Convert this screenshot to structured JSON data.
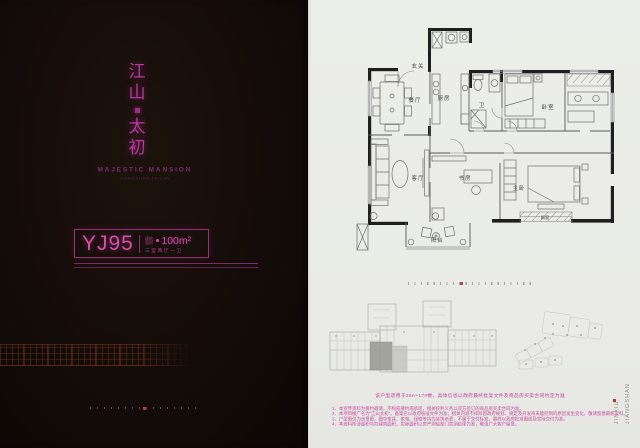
{
  "left_panel": {
    "title_chars": [
      "江",
      "山",
      "太",
      "初"
    ],
    "title_en": "MAJESTIC MANSION",
    "title_sub": "JIANGSHAN TAICHU",
    "unit": {
      "model": "YJ95",
      "area_label_line1": "建筑",
      "area_label_line2": "面积",
      "area": "100m²",
      "layout": "三室两厅一卫"
    }
  },
  "plan": {
    "rooms": {
      "entry": "玄关",
      "dining": "餐厅",
      "kitchen": "厨房",
      "bath": "卫",
      "bedroom": "卧室",
      "living": "客厅",
      "study": "书房",
      "master": "主卧",
      "balcony": "阳台",
      "bay_window": "飘窗"
    }
  },
  "notes": {
    "highlight": "该户型适用于26A+17#楼，具体信息以政府最终批复文件及商品房买卖合同约定为准",
    "items": [
      "1、本宣传资料为要约邀请，不构成要约或承诺，相关权利义务以双方签订的商品房买卖合同为准。",
      "2、本项目推广名为“江山太初”，备案名以政府核准文件为准；相关内容不排除因政府规划、规定及开发商未能控制的原因发生变化，敬请留意最新资料。",
      "3、户型图仅为示意图，图中家具、家电、绿植等均为装饰示意，不属于交付标准，最终以政府批准图纸及实际交付为准。",
      "4、本资料所涉面积均为建筑面积，实际面积以房产测绘部门实测结果为准，敬请广大客户留意。"
    ]
  },
  "side_brand": {
    "word1": "JINXIU",
    "word2": "JIANGSHAN"
  },
  "colors": {
    "magenta": "#bc36a1",
    "pink_text": "#c643a0",
    "red_dot": "#b4403a"
  }
}
